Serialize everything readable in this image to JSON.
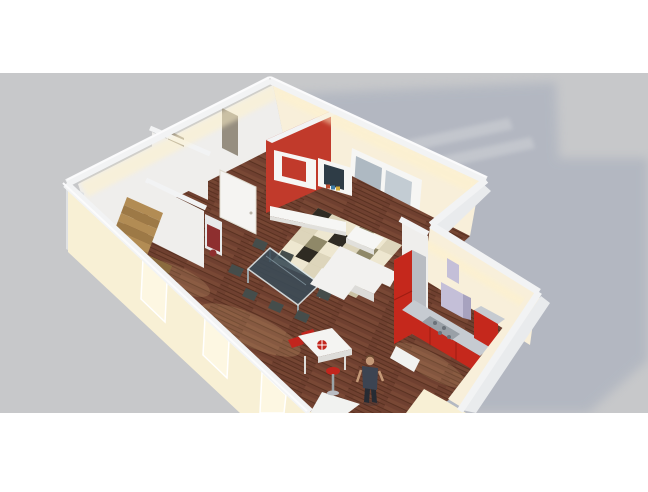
{
  "meta": {
    "title": "3D cutaway rendering of a studio apartment",
    "render_type": "isometric 3d floor-plan render",
    "canvas": {
      "width": 648,
      "height": 492
    }
  },
  "colors": {
    "bg_white": "#ffffff",
    "backdrop": "#c7c8ca",
    "shadow": "#b2b7c1",
    "shadow_stripe": "#c7cad0",
    "wall_cap": "#f2f3f4",
    "wall_cap_hi": "#fbfbfc",
    "wall_outer": "#e9ebed",
    "wall_end": "#dfe1e3",
    "facade": "#f8f0d5",
    "facade_bright": "#fdf7e2",
    "wall_inner": "#efeeec",
    "wall_cream": "#f8efda",
    "glow": "#fff2c9",
    "floor_glow": "#ffdf9e",
    "wood": "#6f4030",
    "wood_light": "#83503a",
    "wood_dark": "#57301f",
    "accent_red": "#c13a2b",
    "kitchen_red": "#c5281c",
    "kitchen_red_dark": "#9e1d12",
    "steel": "#c6cbd1",
    "cooktop": "#99a0a7",
    "cab_side": "#b9bcc2",
    "hood": "#c4bfd8",
    "hood_dark": "#a7a2bf",
    "shelf": "#f6f6f4",
    "shelf_shade": "#e1e0dc",
    "tv": "#2e3c46",
    "book_red": "#bf4a2e",
    "book_blue": "#3d7ba6",
    "book_yellow": "#d2a93c",
    "rug_base": "#cbc2a4",
    "rug_cream": "#eee7d0",
    "rug_beige": "#ddd5bb",
    "rug_olive": "#8f8868",
    "rug_black": "#2f2b23",
    "glass": "#3a4c58",
    "glass_frame": "#dde9ec",
    "chair": "#454d4b",
    "stool": "#c2251d",
    "bar": "#f4f4f2",
    "bar_shade": "#dddcd9",
    "stairs_a": "#b28c54",
    "stairs_b": "#9d7946",
    "stairs_c": "#8a6a3e",
    "door": "#f5f4f2",
    "doorway": "#968e80",
    "radiator": "#8e2f2f",
    "radiator_body": "#e8e9ea",
    "glass_door": "#aeb9c2",
    "glass_door2": "#c3ccd3",
    "skin": "#c59a78",
    "hair": "#6e4f33",
    "shirt": "#3c4452",
    "pants": "#262b33",
    "sofa": "#f2f1ef",
    "sofa_shade": "#dcdbd8",
    "white_goods": "#f1f2f0",
    "leg_metal": "#9aa4a8"
  },
  "scene": {
    "type": "3d-render",
    "description": "Isometric cutaway 3D rendering of an L-shaped studio apartment on a gray backdrop, lit warmly from inside, casting a soft shadow to the upper right. White letterbox bands at top and bottom.",
    "objects": [
      {
        "id": "apartment-shell",
        "label": "L-shaped apartment shell with cutaway white walls"
      },
      {
        "id": "cast-shadow",
        "label": "Soft blue-gray shadow with two light stripes from the glazed doors"
      },
      {
        "id": "staircase",
        "label": "Wooden staircase in left room"
      },
      {
        "id": "hallway",
        "label": "Hallway with partition walls and white doors"
      },
      {
        "id": "tv-wall",
        "label": "Red accent wall with white modular shelving and TV"
      },
      {
        "id": "french-doors",
        "label": "Glazed double doors on the back-right wall"
      },
      {
        "id": "facade-windows",
        "label": "Three tall window slits on the warm front facade"
      },
      {
        "id": "dining-table",
        "label": "Glass dining table with dark chairs"
      },
      {
        "id": "rug",
        "label": "Patchwork area rug in beige, olive and black"
      },
      {
        "id": "sofa",
        "label": "White sofa with white coffee table"
      },
      {
        "id": "kitchen",
        "label": "Red kitchen run with tall cabinet, cooktop, lavender range hood"
      },
      {
        "id": "bar",
        "label": "White bar table with red stools and round red tray"
      },
      {
        "id": "person",
        "label": "Standing person figure on the wood floor"
      },
      {
        "id": "radiator",
        "label": "Small maroon radiator at partition end"
      }
    ]
  }
}
